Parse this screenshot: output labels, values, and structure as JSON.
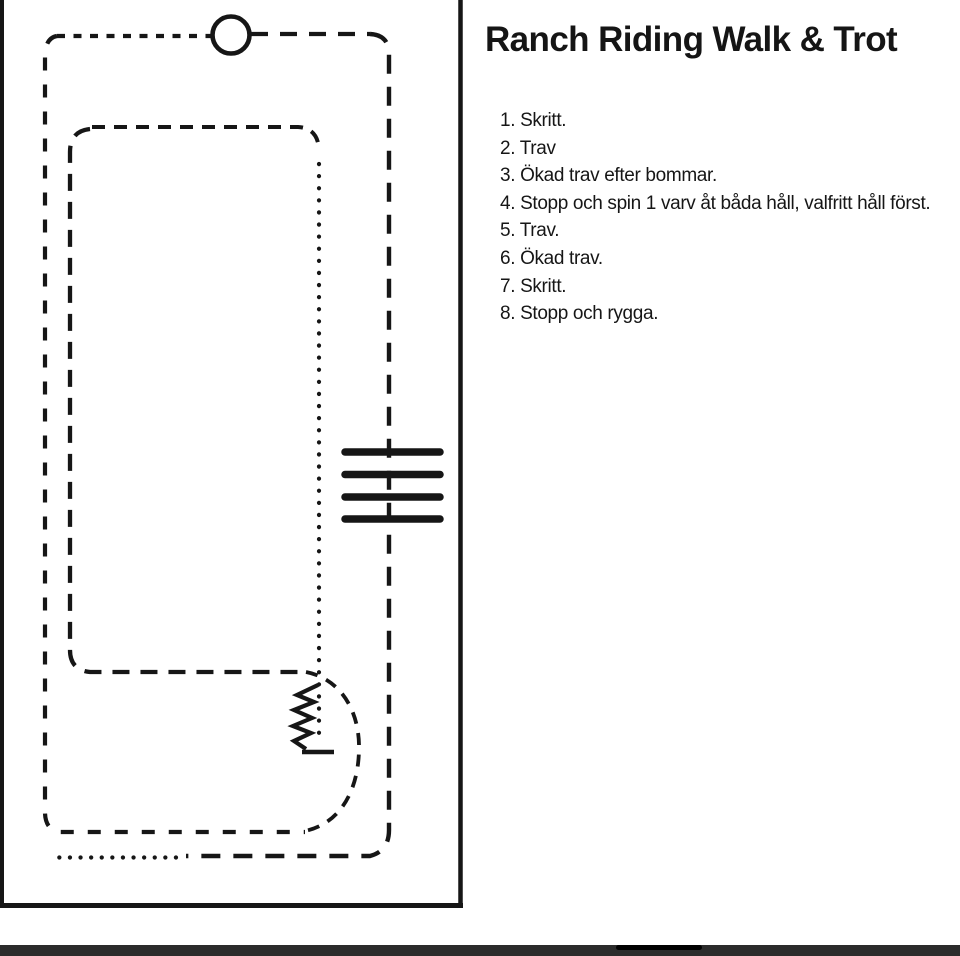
{
  "title": "Ranch Riding Walk & Trot",
  "instructions": [
    "1. Skritt.",
    "2. Trav",
    "3. Ökad trav efter bommar.",
    "4. Stopp och spin 1 varv åt båda håll, valfritt håll först.",
    "5. Trav.",
    "6. Ökad trav.",
    "7. Skritt.",
    "8. Stopp och rygga."
  ],
  "diagram": {
    "pole_count": 4,
    "icons": {
      "start_spin_circle": "circle-marker",
      "trot_poles": "four-horizontal-bars",
      "backup_zigzag": "zigzag-with-stop-line"
    }
  },
  "colors": {
    "ink": "#151515",
    "bottom_bar": "#2b2b2b",
    "scroll_thumb": "#000000"
  }
}
